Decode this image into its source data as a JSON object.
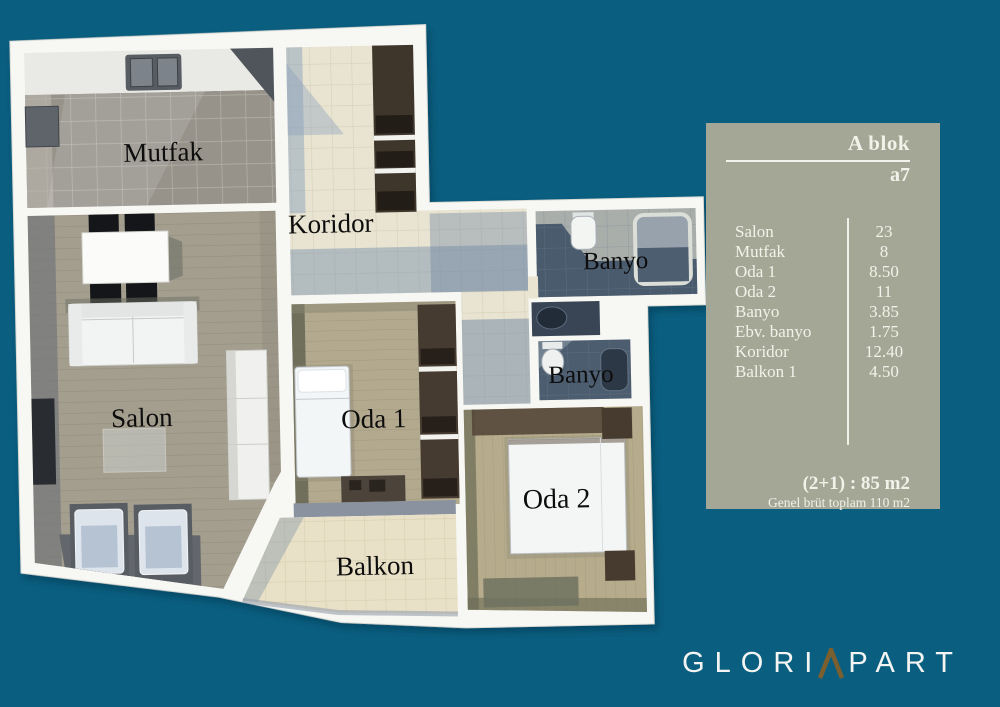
{
  "background_color": "#0a5f80",
  "floor_plan": {
    "rooms": [
      {
        "id": "mutfak",
        "label": "Mutfak"
      },
      {
        "id": "koridor",
        "label": "Koridor"
      },
      {
        "id": "banyo1",
        "label": "Banyo"
      },
      {
        "id": "banyo2",
        "label": "Banyo"
      },
      {
        "id": "salon",
        "label": "Salon"
      },
      {
        "id": "oda1",
        "label": "Oda 1"
      },
      {
        "id": "oda2",
        "label": "Oda 2"
      },
      {
        "id": "balkon",
        "label": "Balkon"
      }
    ]
  },
  "info_panel": {
    "block_title": "A blok",
    "unit_code": "a7",
    "rows": [
      {
        "label": "Salon",
        "value": "23"
      },
      {
        "label": "Mutfak",
        "value": "8"
      },
      {
        "label": "Oda 1",
        "value": "8.50"
      },
      {
        "label": "Oda 2",
        "value": "11"
      },
      {
        "label": "Banyo",
        "value": "3.85"
      },
      {
        "label": "Ebv. banyo",
        "value": "1.75"
      },
      {
        "label": "Koridor",
        "value": "12.40"
      },
      {
        "label": "Balkon 1",
        "value": "4.50"
      }
    ],
    "summary_bold": "(2+1) : 85 m2",
    "summary_small": "Genel brüt toplam 110 m2",
    "panel_bg": "#a5a796",
    "text_color": "#f1f2e9"
  },
  "logo": {
    "text_left": "GLORI",
    "caret_icon": "caret-A",
    "text_right": "PART",
    "caret_color": "#7c5f2f"
  }
}
